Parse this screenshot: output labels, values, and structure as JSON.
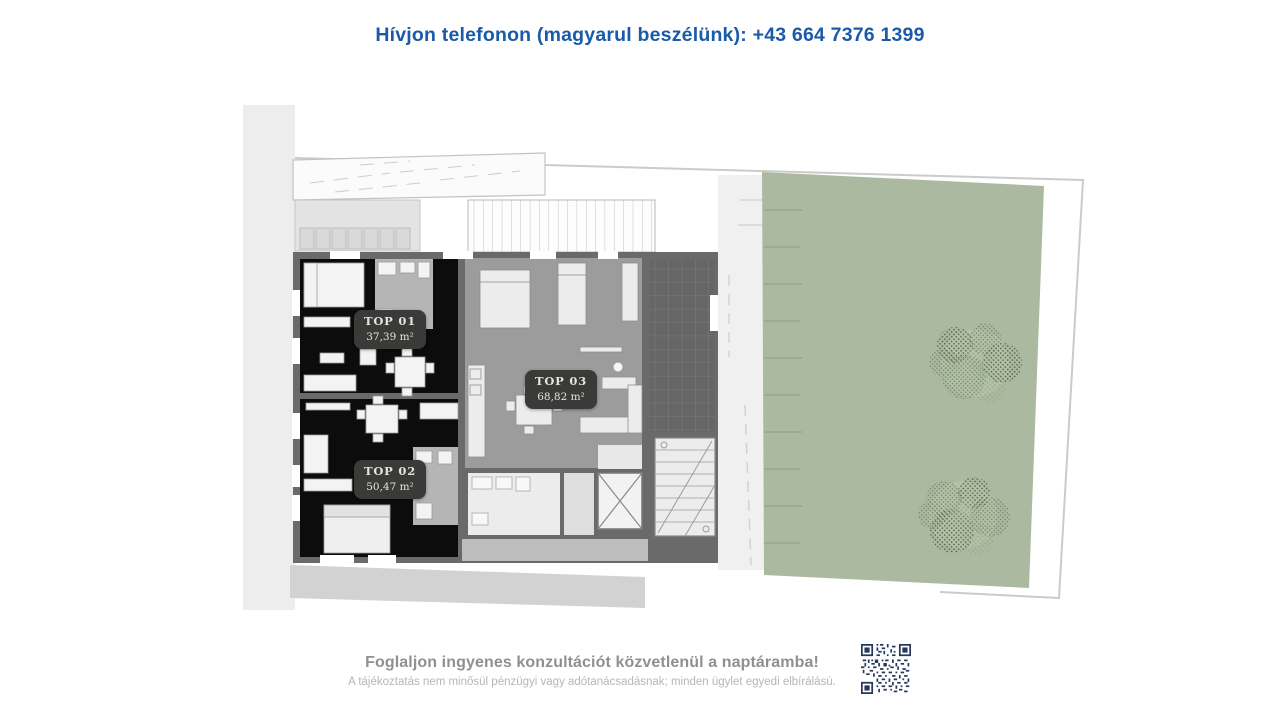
{
  "header": {
    "phone_line": "Hívjon telefonon (magyarul beszélünk): +43 664 7376 1399"
  },
  "floorplan": {
    "units": [
      {
        "id": "TOP 01",
        "area": "37,39 m²"
      },
      {
        "id": "TOP 02",
        "area": "50,47 m²"
      },
      {
        "id": "TOP 03",
        "area": "68,82 m²"
      }
    ]
  },
  "footer": {
    "cta": "Foglaljon ingyenes konzultációt közvetlenül a naptáramba!",
    "disclaimer": "A tájékoztatás nem minősül pénzügyi vagy adótanácsadásnak; minden ügylet egyedi elbírálású."
  },
  "colors": {
    "accent_blue": "#1a5aa8",
    "garden_green": "#aab9a0",
    "qr_navy": "#26395d",
    "badge_dark": "#3a3a38"
  }
}
